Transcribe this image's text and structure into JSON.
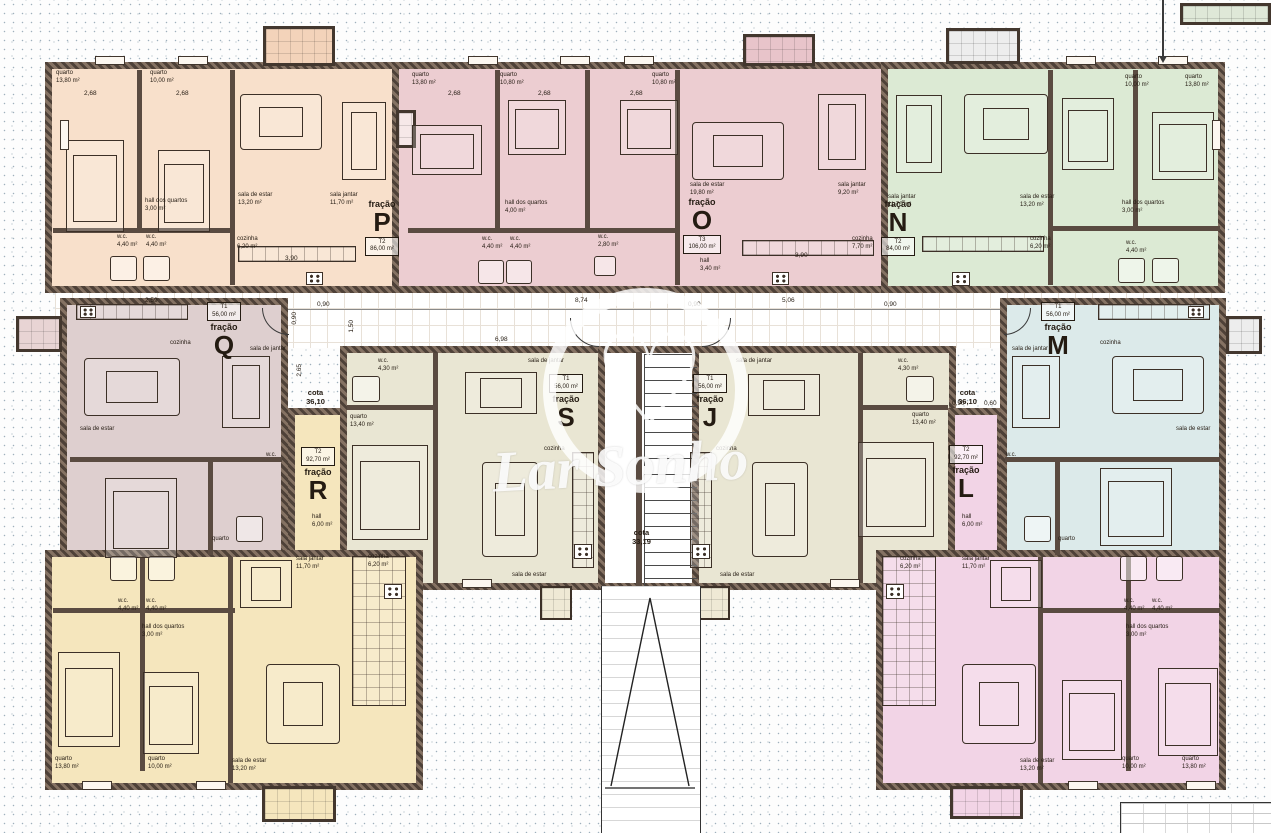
{
  "watermark": {
    "brand": "Lar Sonho"
  },
  "fracao_word": "fração",
  "fracoes": {
    "P": {
      "letter": "P",
      "type": "T2",
      "area": "86,00 m²"
    },
    "O": {
      "letter": "O",
      "type": "T3",
      "area": "106,00 m²"
    },
    "N": {
      "letter": "N",
      "type": "T2",
      "area": "84,00 m²"
    },
    "Q": {
      "letter": "Q",
      "type": "T1",
      "area": "56,00 m²"
    },
    "R": {
      "letter": "R",
      "type": "T2",
      "area": "92,70 m²"
    },
    "S": {
      "letter": "S",
      "type": "T1",
      "area": "56,00 m²"
    },
    "J": {
      "letter": "J",
      "type": "T1",
      "area": "56,00 m²"
    },
    "M": {
      "letter": "M",
      "type": "T1",
      "area": "56,00 m²"
    },
    "L": {
      "letter": "L",
      "type": "T2",
      "area": "92,70 m²"
    }
  },
  "lbl": {
    "quarto_1380": {
      "n": "quarto",
      "a": "13,80 m²"
    },
    "quarto_1000": {
      "n": "quarto",
      "a": "10,00 m²"
    },
    "quarto_1080": {
      "n": "quarto",
      "a": "10,80 m²"
    },
    "quarto_1340": {
      "n": "quarto",
      "a": "13,40 m²"
    },
    "quarto": {
      "n": "quarto"
    },
    "se_1320": {
      "n": "sala de estar",
      "a": "13,20 m²"
    },
    "se_1980": {
      "n": "sala de estar",
      "a": "19,80 m²"
    },
    "se": {
      "n": "sala de estar"
    },
    "sj_1170": {
      "n": "sala jantar",
      "a": "11,70 m²"
    },
    "sj_920": {
      "n": "sala jantar",
      "a": "9,20 m²"
    },
    "sdj": {
      "n": "sala de jantar"
    },
    "coz_620": {
      "n": "cozinha",
      "a": "6,20 m²"
    },
    "coz_770": {
      "n": "cozinha",
      "a": "7,70 m²"
    },
    "coz": {
      "n": "cozinha"
    },
    "hq_300": {
      "n": "hall dos quartos",
      "a": "3,00 m²"
    },
    "hq_400": {
      "n": "hall dos quartos",
      "a": "4,00 m²"
    },
    "hall_340": {
      "n": "hall",
      "a": "3,40 m²"
    },
    "hall_600": {
      "n": "hall",
      "a": "6,00 m²"
    },
    "wc_440": {
      "n": "w.c.",
      "a": "4,40 m²"
    },
    "wc_430": {
      "n": "w.c.",
      "a": "4,30 m²"
    },
    "wc_280": {
      "n": "w.c.",
      "a": "2,80 m²"
    },
    "wc": {
      "n": "w.c."
    }
  },
  "cotas": {
    "word": "cota",
    "left": "36,10",
    "right": "36,10",
    "stairs": "33,19"
  },
  "dims": {
    "top": [
      "2,59",
      "0,90",
      "8,74",
      "0,90",
      "5,06",
      "0,90"
    ],
    "v090": "0,90",
    "v150": "1,50",
    "v265": "2,65",
    "h698": "6,98",
    "b268": "2,68",
    "b390": "3,90",
    "m090": "0,90",
    "m060": "0,60"
  }
}
